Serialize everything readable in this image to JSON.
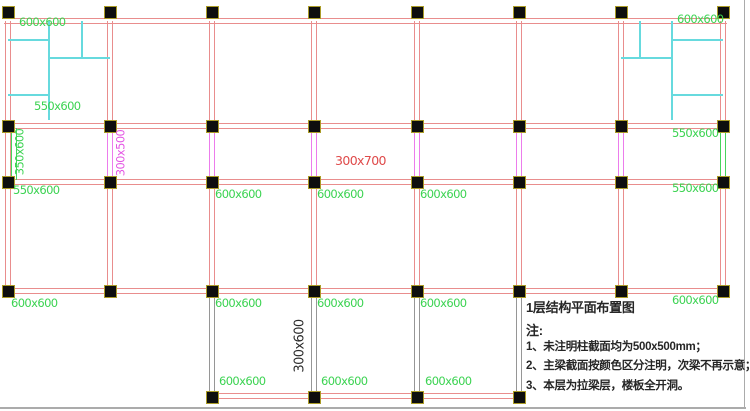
{
  "title_block": {
    "title": "1层结构平面布置图",
    "note_label": "注:",
    "notes": [
      "1、未注明柱截面均为500x500mm；",
      "2、主梁截面按颜色区分注明，次梁不再示意；",
      "3、本层为拉梁层，楼板全开洞。"
    ]
  },
  "colors": {
    "beam_red": "#e98d8d",
    "beam_magenta": "#ec7cec",
    "beam_green": "#46d45c",
    "beam_gray": "#969696",
    "partition_cyan": "#67dade",
    "label_green": "#3cd352",
    "label_magenta": "#e455e4",
    "label_red": "#df4a4a",
    "label_black": "#2b2b2b",
    "column_fill": "#0e0e0e",
    "column_border": "#ab9c28",
    "frame_gray": "#ababab"
  },
  "grid": {
    "cols_x": [
      8,
      110,
      212,
      314,
      417,
      519,
      621,
      723
    ],
    "beam_rows_y": [
      21,
      126,
      182,
      291,
      396
    ]
  },
  "column_markers": {
    "rows": [
      {
        "y": 12,
        "cols": [
          8,
          110,
          212,
          314,
          417,
          519,
          621,
          723
        ]
      },
      {
        "y": 126,
        "cols": [
          8,
          110,
          212,
          314,
          417,
          519,
          621,
          723
        ]
      },
      {
        "y": 182,
        "cols": [
          8,
          110,
          212,
          314,
          417,
          519,
          621,
          723
        ]
      },
      {
        "y": 291,
        "cols": [
          8,
          110,
          212,
          314,
          417,
          519,
          621,
          723
        ]
      },
      {
        "y": 397,
        "cols": [
          212,
          314,
          417,
          519
        ]
      }
    ]
  },
  "beams": [
    {
      "x1": 4,
      "y1": 21,
      "x2": 727,
      "y2": 21,
      "color": "beam_red"
    },
    {
      "x1": 4,
      "y1": 126,
      "x2": 727,
      "y2": 126,
      "color": "beam_red"
    },
    {
      "x1": 4,
      "y1": 182,
      "x2": 727,
      "y2": 182,
      "color": "beam_red"
    },
    {
      "x1": 4,
      "y1": 291,
      "x2": 727,
      "y2": 291,
      "color": "beam_red"
    },
    {
      "x1": 210,
      "y1": 396,
      "x2": 522,
      "y2": 396,
      "color": "beam_red"
    },
    {
      "x1": 8,
      "y1": 21,
      "x2": 8,
      "y2": 126,
      "color": "beam_red"
    },
    {
      "x1": 110,
      "y1": 21,
      "x2": 110,
      "y2": 126,
      "color": "beam_red"
    },
    {
      "x1": 212,
      "y1": 21,
      "x2": 212,
      "y2": 126,
      "color": "beam_red"
    },
    {
      "x1": 314,
      "y1": 21,
      "x2": 314,
      "y2": 126,
      "color": "beam_red"
    },
    {
      "x1": 417,
      "y1": 21,
      "x2": 417,
      "y2": 126,
      "color": "beam_red"
    },
    {
      "x1": 519,
      "y1": 21,
      "x2": 519,
      "y2": 126,
      "color": "beam_red"
    },
    {
      "x1": 621,
      "y1": 21,
      "x2": 621,
      "y2": 126,
      "color": "beam_red"
    },
    {
      "x1": 723,
      "y1": 21,
      "x2": 723,
      "y2": 126,
      "color": "beam_red"
    },
    {
      "x1": 8,
      "y1": 126,
      "x2": 8,
      "y2": 182,
      "color": "beam_red"
    },
    {
      "x1": 14,
      "y1": 128,
      "x2": 14,
      "y2": 180,
      "color": "beam_green"
    },
    {
      "x1": 110,
      "y1": 126,
      "x2": 110,
      "y2": 182,
      "color": "beam_magenta"
    },
    {
      "x1": 212,
      "y1": 126,
      "x2": 212,
      "y2": 182,
      "color": "beam_magenta"
    },
    {
      "x1": 314,
      "y1": 126,
      "x2": 314,
      "y2": 182,
      "color": "beam_magenta"
    },
    {
      "x1": 417,
      "y1": 126,
      "x2": 417,
      "y2": 182,
      "color": "beam_magenta"
    },
    {
      "x1": 519,
      "y1": 126,
      "x2": 519,
      "y2": 182,
      "color": "beam_magenta"
    },
    {
      "x1": 621,
      "y1": 126,
      "x2": 621,
      "y2": 182,
      "color": "beam_magenta"
    },
    {
      "x1": 723,
      "y1": 128,
      "x2": 723,
      "y2": 180,
      "color": "beam_green"
    },
    {
      "x1": 8,
      "y1": 182,
      "x2": 8,
      "y2": 291,
      "color": "beam_red"
    },
    {
      "x1": 110,
      "y1": 182,
      "x2": 110,
      "y2": 291,
      "color": "beam_red"
    },
    {
      "x1": 212,
      "y1": 182,
      "x2": 212,
      "y2": 291,
      "color": "beam_red"
    },
    {
      "x1": 314,
      "y1": 182,
      "x2": 314,
      "y2": 291,
      "color": "beam_red"
    },
    {
      "x1": 417,
      "y1": 182,
      "x2": 417,
      "y2": 291,
      "color": "beam_red"
    },
    {
      "x1": 519,
      "y1": 182,
      "x2": 519,
      "y2": 291,
      "color": "beam_red"
    },
    {
      "x1": 621,
      "y1": 182,
      "x2": 621,
      "y2": 291,
      "color": "beam_red"
    },
    {
      "x1": 723,
      "y1": 182,
      "x2": 723,
      "y2": 291,
      "color": "beam_red"
    },
    {
      "x1": 212,
      "y1": 291,
      "x2": 212,
      "y2": 397,
      "color": "beam_gray"
    },
    {
      "x1": 314,
      "y1": 291,
      "x2": 314,
      "y2": 397,
      "color": "beam_gray"
    },
    {
      "x1": 417,
      "y1": 291,
      "x2": 417,
      "y2": 397,
      "color": "beam_gray"
    },
    {
      "x1": 519,
      "y1": 291,
      "x2": 519,
      "y2": 397,
      "color": "beam_gray"
    }
  ],
  "partitions": [
    {
      "x1": 49,
      "y1": 21,
      "x2": 49,
      "y2": 120,
      "color": "partition_cyan",
      "w": 2
    },
    {
      "x1": 8,
      "y1": 40,
      "x2": 49,
      "y2": 40,
      "color": "partition_cyan",
      "w": 2
    },
    {
      "x1": 8,
      "y1": 95,
      "x2": 49,
      "y2": 95,
      "color": "partition_cyan",
      "w": 2
    },
    {
      "x1": 49,
      "y1": 58,
      "x2": 110,
      "y2": 58,
      "color": "partition_cyan",
      "w": 2
    },
    {
      "x1": 82,
      "y1": 21,
      "x2": 82,
      "y2": 58,
      "color": "partition_cyan",
      "w": 2
    },
    {
      "x1": 672,
      "y1": 21,
      "x2": 672,
      "y2": 120,
      "color": "partition_cyan",
      "w": 2
    },
    {
      "x1": 672,
      "y1": 40,
      "x2": 723,
      "y2": 40,
      "color": "partition_cyan",
      "w": 2
    },
    {
      "x1": 672,
      "y1": 95,
      "x2": 723,
      "y2": 95,
      "color": "partition_cyan",
      "w": 2
    },
    {
      "x1": 621,
      "y1": 58,
      "x2": 672,
      "y2": 58,
      "color": "partition_cyan",
      "w": 2
    },
    {
      "x1": 640,
      "y1": 21,
      "x2": 640,
      "y2": 58,
      "color": "partition_cyan",
      "w": 2
    },
    {
      "x1": 744,
      "y1": 0,
      "x2": 744,
      "y2": 409,
      "color": "frame_gray",
      "w": 1
    },
    {
      "x1": 0,
      "y1": 408,
      "x2": 746,
      "y2": 408,
      "color": "frame_gray",
      "w": 2
    }
  ],
  "dimension_labels": [
    {
      "t": "600x600",
      "x": 19,
      "y": 17,
      "c": "label_green"
    },
    {
      "t": "600x600",
      "x": 677,
      "y": 14,
      "c": "label_green"
    },
    {
      "t": "550x600",
      "x": 34,
      "y": 101,
      "c": "label_green"
    },
    {
      "t": "550x600",
      "x": 672,
      "y": 128,
      "c": "label_green"
    },
    {
      "t": "350x600",
      "x": 20,
      "y": 152,
      "c": "label_green",
      "rot": true
    },
    {
      "t": "300x500",
      "x": 121,
      "y": 153,
      "c": "label_magenta",
      "rot": true
    },
    {
      "t": "300x700",
      "x": 335,
      "y": 155,
      "c": "label_red",
      "fs": 12.5
    },
    {
      "t": "550x600",
      "x": 13,
      "y": 185,
      "c": "label_green"
    },
    {
      "t": "600x600",
      "x": 215,
      "y": 189,
      "c": "label_green"
    },
    {
      "t": "600x600",
      "x": 317,
      "y": 189,
      "c": "label_green"
    },
    {
      "t": "600x600",
      "x": 420,
      "y": 189,
      "c": "label_green"
    },
    {
      "t": "550x600",
      "x": 672,
      "y": 183,
      "c": "label_green"
    },
    {
      "t": "600x600",
      "x": 11,
      "y": 298,
      "c": "label_green"
    },
    {
      "t": "600x600",
      "x": 215,
      "y": 298,
      "c": "label_green"
    },
    {
      "t": "600x600",
      "x": 317,
      "y": 298,
      "c": "label_green"
    },
    {
      "t": "600x600",
      "x": 420,
      "y": 298,
      "c": "label_green"
    },
    {
      "t": "600x600",
      "x": 672,
      "y": 295,
      "c": "label_green"
    },
    {
      "t": "300x600",
      "x": 300,
      "y": 346,
      "c": "label_black",
      "rot": true,
      "fs": 13
    },
    {
      "t": "600x600",
      "x": 219,
      "y": 376,
      "c": "label_green"
    },
    {
      "t": "600x600",
      "x": 321,
      "y": 376,
      "c": "label_green"
    },
    {
      "t": "600x600",
      "x": 425,
      "y": 376,
      "c": "label_green"
    }
  ]
}
